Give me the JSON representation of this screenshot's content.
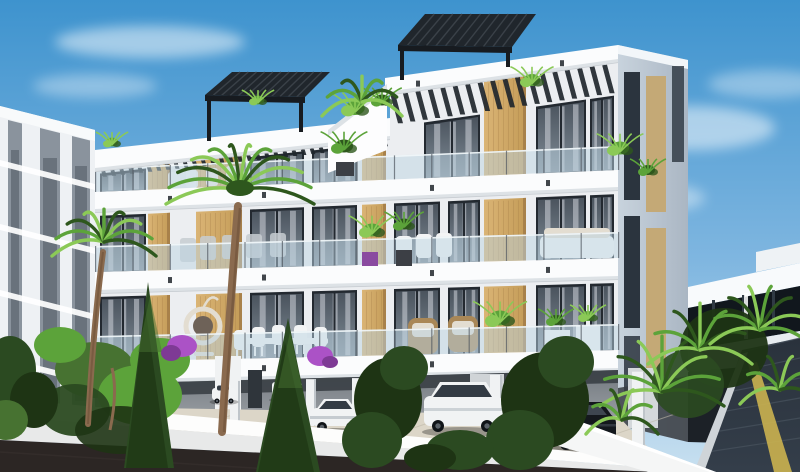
{
  "scene": {
    "type": "architectural-exterior-render",
    "subject": "modern-three-story-apartment-building",
    "objects": [
      "blue-sky",
      "soft-clouds",
      "background-apartment-building",
      "neighbor-modern-house",
      "main-building-front-facade",
      "main-building-side-facade",
      "white-floor-slabs",
      "timber-clad-piers",
      "black-framed-glass-doors",
      "frameless-glass-balustrades",
      "black-roof-pergola-left",
      "black-roof-pergola-right",
      "roof-stair-parapet",
      "under-slab-louvre-rafters",
      "ground-floor-parking",
      "white-columns",
      "white-sport-car",
      "white-suv",
      "distant-white-cars",
      "dark-luxury-car",
      "travertine-parking-floor",
      "white-boundary-wall",
      "asphalt-road",
      "driveway-ramp",
      "yellow-curb-stripe",
      "white-planter-walls",
      "curved-palm-tree-left",
      "curved-palm-tree-center",
      "dark-conifers",
      "leafy-shrubs",
      "tropical-palm-cluster",
      "magenta-flower-bushes",
      "balcony-plants",
      "white-outdoor-dining-set",
      "wicker-armchairs",
      "hanging-egg-chair",
      "white-lounge-furniture"
    ]
  },
  "palette": {
    "sky_top": "#3e93ce",
    "sky_mid": "#7fb6e0",
    "sky_low": "#c8e0f0",
    "cloud_white": "#ffffff",
    "bg_wall": "#eef1f4",
    "bg_band": "#8a939d",
    "bg_slot": "#606a74",
    "bg_roof": "#f8fafb",
    "neighbor_white": "#f8fafc",
    "neighbor_parapet": "#eef2f5",
    "neighbor_glass": "#11171d",
    "neighbor_wall": "#e7ecef",
    "neighbor_dark": "#1c2127",
    "neighbor_mullion": "#303a44",
    "side_light": "#c8d3dd",
    "side_dark": "#aab6c3",
    "side_slot": "#2b343e",
    "side_wood": "#c4a976",
    "wall_recess": "#eceef1",
    "slab_white": "#fbfcfd",
    "slab_under": "#dde2e6",
    "slab_edge": "#c8cdd2",
    "rafter": "#20262c",
    "frame": "#232930",
    "glass_dark": "#4a535d",
    "glass_light": "#7f8b96",
    "curtain": "#cfd4da",
    "wood_light": "#dab475",
    "wood": "#c49c58",
    "wood_shade": "#a8814a",
    "rail_glass": "#bcd4e2",
    "rail_post": "#4e565e",
    "rail_top": "#f2f7fa",
    "park_back": "#73797f",
    "park_back_light": "#a3a8ad",
    "park_ceiling": "#383d43",
    "park_strip": "#d0d4d7",
    "park_door": "#2f353b",
    "column": "#f0f2f3",
    "column_shade": "#bfc5ca",
    "floor_pave": "#dcd6c8",
    "floor_pave_dark": "#bfb9aa",
    "wall_top": "#fdfdfc",
    "wall_face": "#e8e9e9",
    "asphalt": "#2c2624",
    "ramp": "#343e4a",
    "ramp_line": "#49545f",
    "ramp_yellow": "#c8b04f",
    "car_white": "#f1f3f4",
    "car_shade": "#a8b1b8",
    "car_glass": "#333b44",
    "car_dark": "#14181d",
    "car_dark_hi": "#3e4650",
    "tire": "#101418",
    "leaf_bright": "#8bc957",
    "leaf_mid": "#5ca33a",
    "leaf_dark": "#2e571d",
    "conifer": "#2b4a21",
    "conifer_dark": "#1e3414",
    "shrub": "#477231",
    "trunk": "#8a6a4e",
    "wicker": "#a98757",
    "cushion": "#e3ddd1",
    "furn_white": "#f3f4f5",
    "furn_gray": "#c7ccd1",
    "magenta": "#ab52c6",
    "magenta_dark": "#7e3a95",
    "planter_white": "#f5f6f6"
  },
  "generation": {
    "rafter_slats_left_wing": 32,
    "rafter_slats_right_wing": 18,
    "balustrade_posts_per_floor": 14,
    "pergola_slats": 12,
    "palm_fronds_large": 12,
    "palm_fronds_small": 9,
    "tropical_frond_clusters": 4,
    "pavement_joint_lines": 5,
    "ramp_joint_lines": 6,
    "curtain_stripes_per_window": 3
  }
}
